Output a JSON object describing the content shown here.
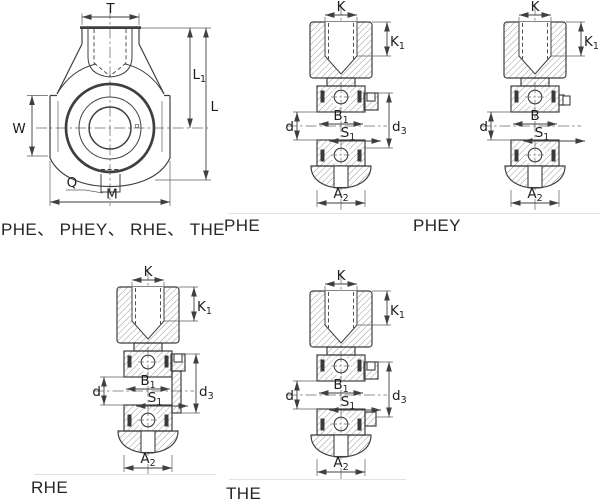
{
  "drawing_title": "Hanger bearing housing units - dimension drawing",
  "views": {
    "front": {
      "caption": "PHE、 PHEY、 RHE、 THE",
      "dims_shown": [
        "T",
        "L1",
        "L",
        "W",
        "Q",
        "M"
      ]
    },
    "phe": {
      "caption": "PHE",
      "dims_shown": [
        "K",
        "K1",
        "B1",
        "S1",
        "d",
        "d3",
        "A2"
      ]
    },
    "phey": {
      "caption": "PHEY",
      "dims_shown": [
        "K",
        "K1",
        "B",
        "S1",
        "d",
        "A2"
      ]
    },
    "rhe": {
      "caption": "RHE",
      "dims_shown": [
        "K",
        "K1",
        "B1",
        "S1",
        "d",
        "d3",
        "A2"
      ]
    },
    "the": {
      "caption": "THE",
      "dims_shown": [
        "K",
        "K1",
        "B1",
        "S1",
        "d",
        "d3",
        "A2"
      ]
    }
  },
  "dims": {
    "T": {
      "base": "T",
      "sub": ""
    },
    "L": {
      "base": "L",
      "sub": ""
    },
    "L1": {
      "base": "L",
      "sub": "1"
    },
    "W": {
      "base": "W",
      "sub": ""
    },
    "Q": {
      "base": "Q",
      "sub": ""
    },
    "M": {
      "base": "M",
      "sub": ""
    },
    "K": {
      "base": "K",
      "sub": ""
    },
    "K1": {
      "base": "K",
      "sub": "1"
    },
    "B": {
      "base": "B",
      "sub": ""
    },
    "B1": {
      "base": "B",
      "sub": "1"
    },
    "S1": {
      "base": "S",
      "sub": "1"
    },
    "d": {
      "base": "d",
      "sub": ""
    },
    "d3": {
      "base": "d",
      "sub": "3"
    },
    "A2": {
      "base": "A",
      "sub": "2"
    }
  },
  "colors": {
    "background": "#ffffff",
    "line": "#3f3f3f",
    "centerline": "#6b6b6b",
    "hatch": "#7a7a7a",
    "text": "#1e1e1e",
    "divider": "#e2e2e2"
  }
}
